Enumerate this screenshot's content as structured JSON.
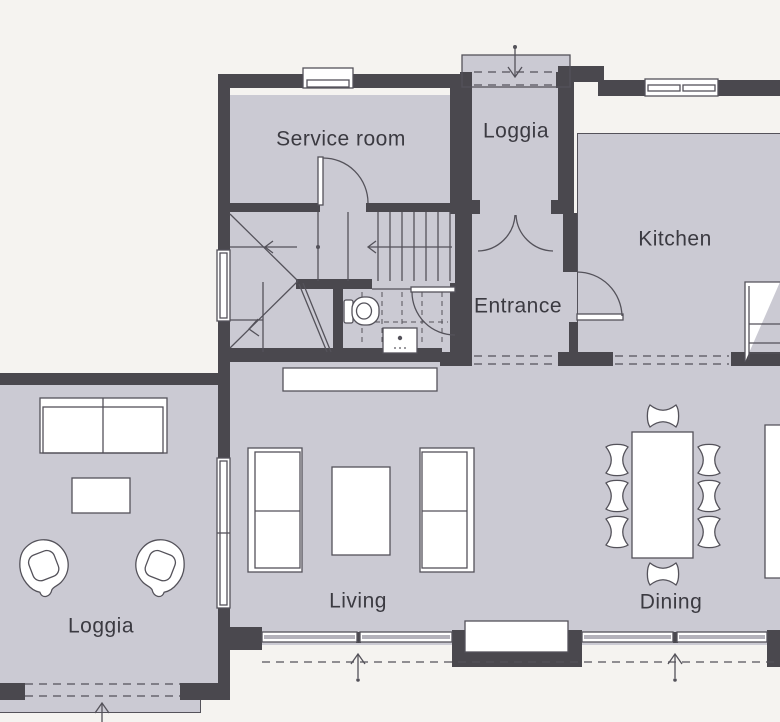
{
  "drawing": {
    "type": "architectural-floor-plan",
    "colors": {
      "paper": "#f5f3f0",
      "floor_fill": "#cbcad3",
      "wall_fill": "#4a484e",
      "line": "#54525a",
      "text": "#3b3a41"
    }
  },
  "rooms": [
    {
      "id": "service-room",
      "label": "Service room"
    },
    {
      "id": "loggia-upper",
      "label": "Loggia"
    },
    {
      "id": "kitchen",
      "label": "Kitchen"
    },
    {
      "id": "entrance",
      "label": "Entrance"
    },
    {
      "id": "living",
      "label": "Living"
    },
    {
      "id": "dining",
      "label": "Dining"
    },
    {
      "id": "loggia-lower",
      "label": "Loggia"
    }
  ],
  "symbols": {
    "entry_arrows": 4,
    "stair": "u-shaped winder stair with direction arrows",
    "fixtures": [
      "toilet",
      "washbasin",
      "kitchen-counter",
      "chimney"
    ],
    "furniture": [
      "sofa",
      "coffee-table",
      "armchair",
      "dining-table",
      "dining-chairs",
      "sideboard"
    ]
  }
}
